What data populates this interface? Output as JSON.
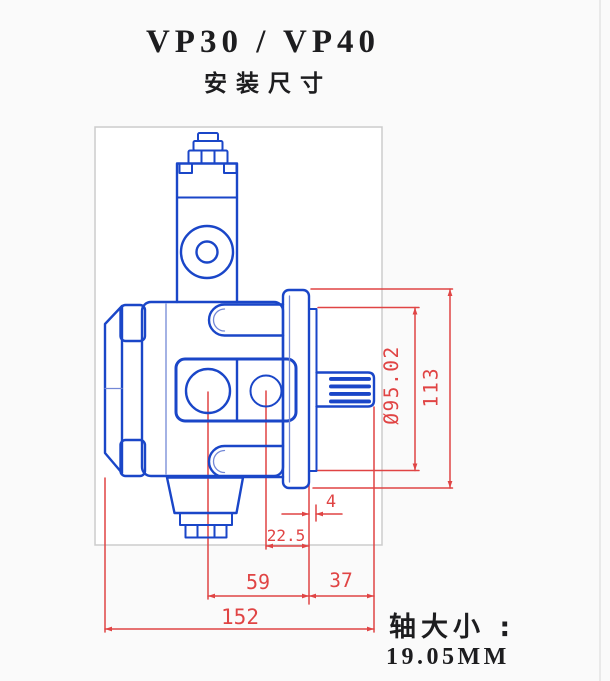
{
  "header": {
    "title": "VP30 / VP40",
    "subtitle": "安装尺寸"
  },
  "footer": {
    "label": "轴大小 :",
    "value": "19.05MM"
  },
  "dimensions": {
    "pilot_diameter": "Ø95.02",
    "flange_height": "113",
    "pilot_protrusion": "4",
    "port_to_face": "22.5",
    "center_to_face": "59",
    "shaft_extension": "37",
    "overall_length": "152"
  },
  "colors": {
    "drawing": "#1a46c8",
    "drawing_light": "#7388d6",
    "dimension": "#e04444",
    "frame_border": "#cccccc",
    "ink": "#1d1d1f",
    "paper": "#fafafa",
    "panel": "#ffffff"
  }
}
